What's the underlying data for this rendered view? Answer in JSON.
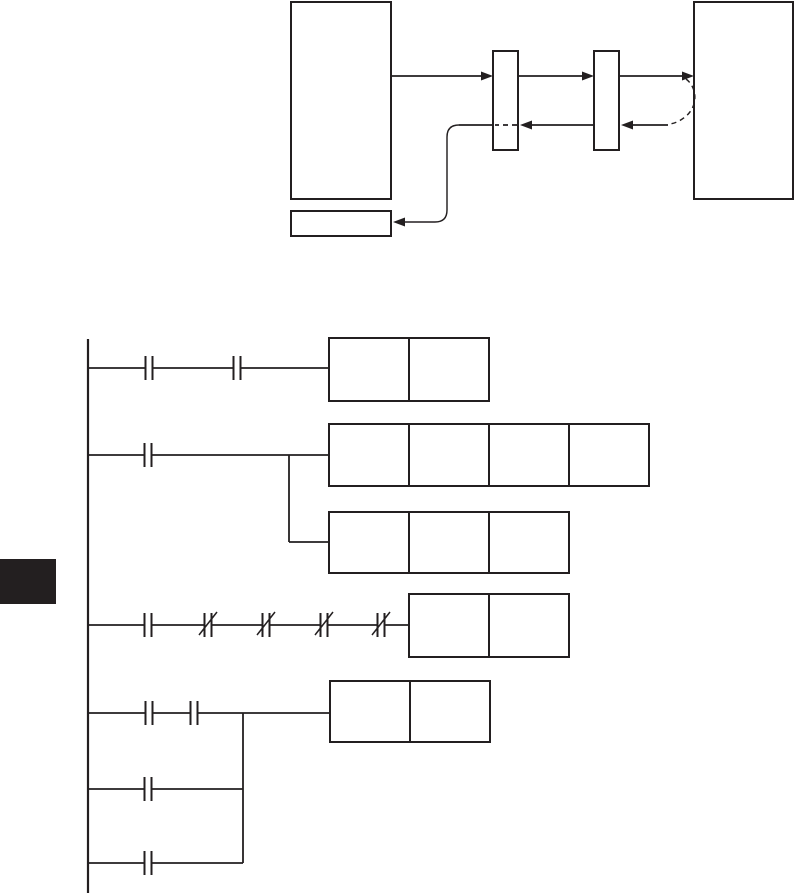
{
  "page": {
    "width": 796,
    "height": 894,
    "background_color": "#ffffff",
    "ink_color": "#231f20",
    "line_width": 1.8,
    "box_stroke_width": 2
  },
  "block_diagram": {
    "boxes": [
      {
        "name": "source-device-box",
        "x": 291,
        "y": 2,
        "w": 100,
        "h": 197
      },
      {
        "name": "interface-module-1-box",
        "x": 493,
        "y": 51,
        "w": 25,
        "h": 99
      },
      {
        "name": "interface-module-2-box",
        "x": 594,
        "y": 51,
        "w": 25,
        "h": 99
      },
      {
        "name": "destination-device-box",
        "x": 694,
        "y": 2,
        "w": 99,
        "h": 197
      },
      {
        "name": "result-box",
        "x": 291,
        "y": 211,
        "w": 100,
        "h": 25
      }
    ],
    "solid_lines": [
      {
        "name": "forward-line-1",
        "x1": 391,
        "y1": 76,
        "x2": 490,
        "y2": 76
      },
      {
        "name": "forward-line-2",
        "x1": 518,
        "y1": 76,
        "x2": 591,
        "y2": 76
      },
      {
        "name": "forward-line-3",
        "x1": 619,
        "y1": 76,
        "x2": 691,
        "y2": 76
      },
      {
        "name": "return-line-1",
        "x1": 668,
        "y1": 125,
        "x2": 633,
        "y2": 125
      },
      {
        "name": "return-line-2",
        "x1": 594,
        "y1": 125,
        "x2": 532,
        "y2": 125
      },
      {
        "name": "return-line-3",
        "x1": 493,
        "y1": 125,
        "x2": 459,
        "y2": 125
      }
    ],
    "dashed_lines": [
      {
        "name": "return-dashed-through-module-1",
        "x1": 517,
        "y1": 125,
        "x2": 495,
        "y2": 125
      }
    ],
    "paths": [
      {
        "name": "return-curve-to-result-box",
        "dashed": false,
        "d": "M 459 125 Q 447 125 447 137 L 447 210 Q 447 222 435 222 L 398 222"
      },
      {
        "name": "dashed-loopback-arc",
        "dashed": true,
        "d": "M 686 79 C 697 87 699 106 685 117 C 680 121 674 124 668 124"
      }
    ],
    "arrows": [
      {
        "name": "arrow-into-module-1",
        "tip_x": 493,
        "tip_y": 76,
        "dir": "right"
      },
      {
        "name": "arrow-into-module-2",
        "tip_x": 594,
        "tip_y": 76,
        "dir": "right"
      },
      {
        "name": "arrow-into-destination",
        "tip_x": 694,
        "tip_y": 76,
        "dir": "right"
      },
      {
        "name": "arrow-return-into-module-2",
        "tip_x": 621,
        "tip_y": 125,
        "dir": "left"
      },
      {
        "name": "arrow-return-into-module-1",
        "tip_x": 520,
        "tip_y": 125,
        "dir": "left"
      },
      {
        "name": "arrow-into-result-box",
        "tip_x": 393,
        "tip_y": 222,
        "dir": "left"
      }
    ]
  },
  "ladder_diagram": {
    "rail": {
      "name": "left-power-rail",
      "x": 88,
      "y1": 339,
      "y2": 893
    },
    "rungs": [
      {
        "name": "rung-1",
        "x1": 88,
        "x2": 329,
        "y": 368
      },
      {
        "name": "rung-2",
        "x1": 88,
        "x2": 329,
        "y": 455
      },
      {
        "name": "rung-2-sub-branch",
        "x1": 289,
        "x2": 329,
        "y": 542
      },
      {
        "name": "rung-3",
        "x1": 88,
        "x2": 409,
        "y": 625
      },
      {
        "name": "rung-4",
        "x1": 88,
        "x2": 330,
        "y": 713
      },
      {
        "name": "rung-5",
        "x1": 88,
        "x2": 243,
        "y": 789
      },
      {
        "name": "rung-6",
        "x1": 88,
        "x2": 243,
        "y": 863
      }
    ],
    "branches": [
      {
        "name": "branch-rung-2-down",
        "x": 289,
        "y1": 455,
        "y2": 542
      },
      {
        "name": "branch-rung-4-down",
        "x": 243,
        "y1": 713,
        "y2": 863
      }
    ],
    "contacts": [
      {
        "name": "contact-no-r1-a",
        "type": "no",
        "cx": 149,
        "y": 368
      },
      {
        "name": "contact-no-r1-b",
        "type": "no",
        "cx": 237,
        "y": 368
      },
      {
        "name": "contact-no-r2",
        "type": "no",
        "cx": 148,
        "y": 455
      },
      {
        "name": "contact-no-r3",
        "type": "no",
        "cx": 148,
        "y": 625
      },
      {
        "name": "contact-nc-r3-a",
        "type": "nc",
        "cx": 208,
        "y": 625
      },
      {
        "name": "contact-nc-r3-b",
        "type": "nc",
        "cx": 266,
        "y": 625
      },
      {
        "name": "contact-nc-r3-c",
        "type": "nc",
        "cx": 324,
        "y": 625
      },
      {
        "name": "contact-nc-r3-d",
        "type": "nc",
        "cx": 381,
        "y": 625
      },
      {
        "name": "contact-no-r4-a",
        "type": "no",
        "cx": 149,
        "y": 713
      },
      {
        "name": "contact-no-r4-b",
        "type": "no",
        "cx": 194,
        "y": 713
      },
      {
        "name": "contact-no-r5",
        "type": "no",
        "cx": 148,
        "y": 789
      },
      {
        "name": "contact-no-r6",
        "type": "no",
        "cx": 148,
        "y": 863
      }
    ],
    "contact_style": {
      "bar_half_height": 12,
      "gap": 7,
      "slash_dx": 9,
      "slash_up": 13,
      "slash_down": 10
    },
    "instruction_boxes": [
      {
        "name": "instruction-box-rung-1",
        "x": 329,
        "y": 338,
        "cells": 2,
        "cell_w": 80,
        "h": 63
      },
      {
        "name": "instruction-box-rung-2",
        "x": 329,
        "y": 424,
        "cells": 4,
        "cell_w": 80,
        "h": 62
      },
      {
        "name": "instruction-box-rung-2-sub",
        "x": 329,
        "y": 512,
        "cells": 3,
        "cell_w": 80,
        "h": 61
      },
      {
        "name": "instruction-box-rung-3",
        "x": 409,
        "y": 594,
        "cells": 2,
        "cell_w": 80,
        "h": 63
      },
      {
        "name": "instruction-box-rung-4",
        "x": 330,
        "y": 681,
        "cells": 2,
        "cell_w": 80,
        "h": 61
      }
    ]
  },
  "section_tab": {
    "name": "page-edge-section-tab",
    "x": 0,
    "y": 559,
    "w": 56,
    "h": 45,
    "fill": "#231f20"
  }
}
